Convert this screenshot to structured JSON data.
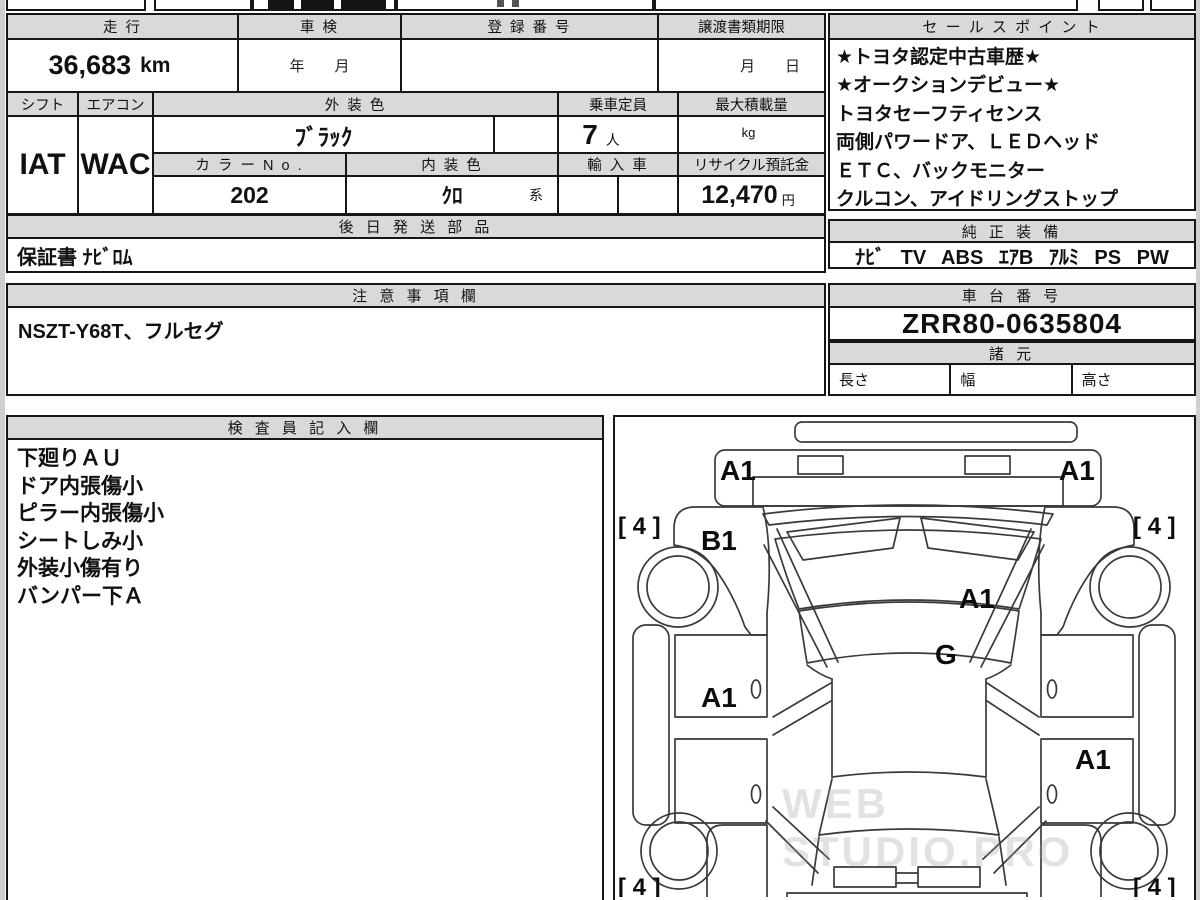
{
  "watermark": "WEB STUDIO.PRO",
  "fields": {
    "mileage": {
      "label": "走 行",
      "value": "36,683",
      "unit": "km"
    },
    "shaken": {
      "label": "車 検",
      "value": "年　　月"
    },
    "registration": {
      "label": "登 録 番 号",
      "value": ""
    },
    "transfer": {
      "label": "譲渡書類期限",
      "value": "月　　日"
    },
    "shift": {
      "label": "シフト",
      "value": "IAT"
    },
    "aircon": {
      "label": "エアコン",
      "value": "WAC"
    },
    "exterior_color": {
      "label": "外 装 色",
      "value": "ﾌﾞﾗｯｸ"
    },
    "capacity": {
      "label": "乗車定員",
      "value": "7",
      "unit": "人"
    },
    "max_load": {
      "label": "最大積載量",
      "value": "",
      "unit": "kg"
    },
    "color_no": {
      "label": "カ ラ ー N o .",
      "value": "202"
    },
    "interior_color": {
      "label": "内 装 色",
      "value": "ｸﾛ",
      "suffix": "系"
    },
    "import_car": {
      "label": "輸 入 車",
      "value": ""
    },
    "recycle_deposit": {
      "label": "リサイクル預託金",
      "value": "12,470",
      "unit": "円"
    }
  },
  "sales_points": {
    "title": "セ ー ル ス ポ イ ン ト",
    "lines": [
      "★トヨタ認定中古車歴★",
      "★オークションデビュー★",
      "トヨタセーフティセンス",
      "両側パワードア、ＬＥＤヘッド",
      "ＥＴＣ、バックモニター",
      "クルコン、アイドリングストップ"
    ]
  },
  "later_parts": {
    "title": "後 日 発 送 部 品",
    "value": "保証書 ﾅﾋﾞﾛﾑ"
  },
  "genuine_equipment": {
    "title": "純 正 装 備",
    "value": "ﾅﾋﾞ TV ABS ｴｱB ｱﾙﾐ PS PW"
  },
  "notes": {
    "title": "注 意 事 項 欄",
    "value": "NSZT-Y68T、フルセグ"
  },
  "chassis": {
    "title": "車 台 番 号",
    "value": "ZRR80-0635804"
  },
  "specs": {
    "title": "諸 元",
    "length_label": "長さ",
    "width_label": "幅",
    "height_label": "高さ"
  },
  "inspector": {
    "title": "検 査 員 記 入 欄",
    "lines": [
      "下廻りＡＵ",
      "ドア内張傷小",
      "ピラー内張傷小",
      "シートしみ小",
      "外装小傷有り",
      "バンパー下Ａ"
    ]
  },
  "diagram": {
    "front_left": "A1",
    "front_right": "A1",
    "fender_left": "B1",
    "hood": "A1",
    "glass": "G",
    "door_left": "A1",
    "door_right": "A1",
    "tire_front_left": "[ 4 ]",
    "tire_front_right": "[ 4 ]",
    "tire_rear_left": "[ 4 ]",
    "tire_rear_right": "[ 4 ]"
  }
}
